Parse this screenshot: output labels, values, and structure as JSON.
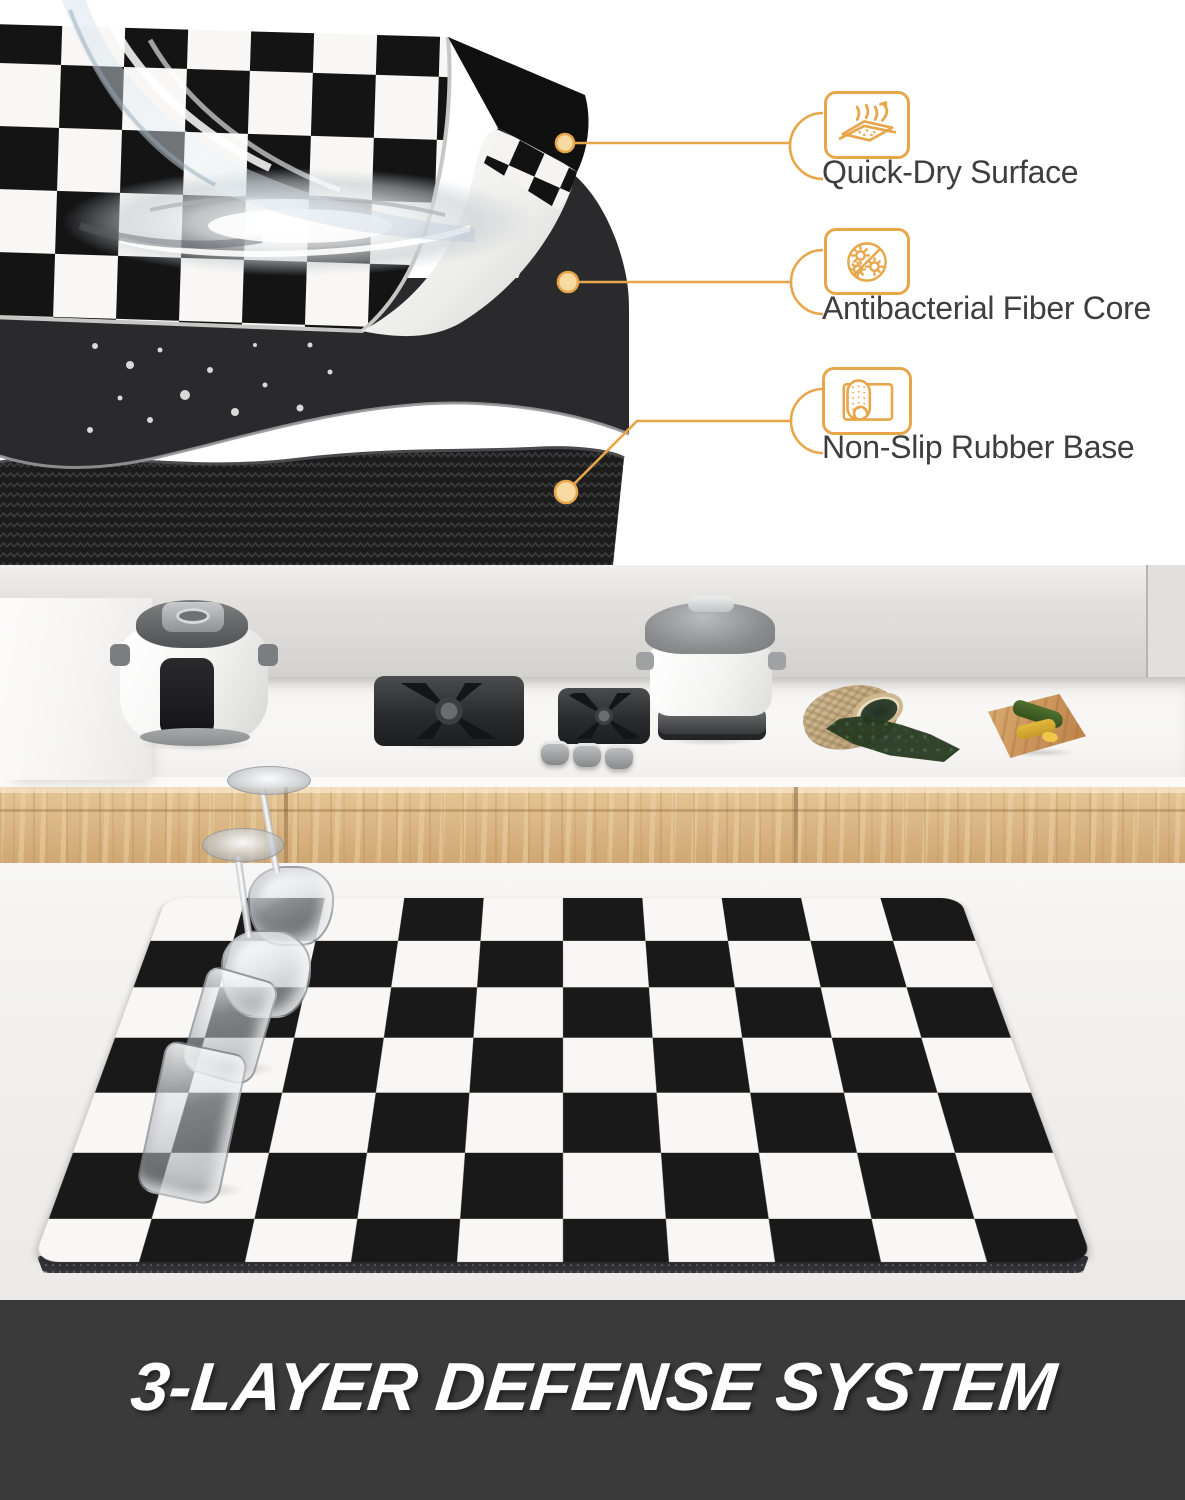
{
  "callouts": [
    {
      "label": "Quick-Dry Surface",
      "icon": "quick-dry-surface-icon"
    },
    {
      "label": "Antibacterial Fiber Core",
      "icon": "antibacterial-fiber-core-icon"
    },
    {
      "label": "Non-Slip Rubber Base",
      "icon": "non-slip-rubber-base-icon"
    }
  ],
  "banner": {
    "title": "3-LAYER DEFENSE SYSTEM",
    "background": "#3a3a3a",
    "text_color": "#ffffff"
  },
  "palette": {
    "accent_orange": "#E8A64B",
    "accent_dot_fill": "#F7D9A2",
    "checker_black": "#191919",
    "checker_white": "#f8f7f5",
    "fiber_core_gray": "#2a2a2c",
    "rubber_base_black": "#1c1c1d",
    "wood_cabinet": "#dcbb8a",
    "wall_gray": "#d8d6d3",
    "counter_white": "#f6f5f3"
  },
  "scene": {
    "top_layers": [
      "checkered quick-dry surface with water pour and swirl",
      "dark antibacterial fiber core with droplets",
      "herringbone non-slip rubber base"
    ],
    "kitchen_objects": [
      "pressure-cooker",
      "gas-burner",
      "stove-knobs",
      "lidded-pot",
      "herb-sack",
      "cutting-board",
      "checkered-drying-mat",
      "wine-glass",
      "wine-glass",
      "tumbler-glass",
      "tumbler-glass"
    ]
  }
}
